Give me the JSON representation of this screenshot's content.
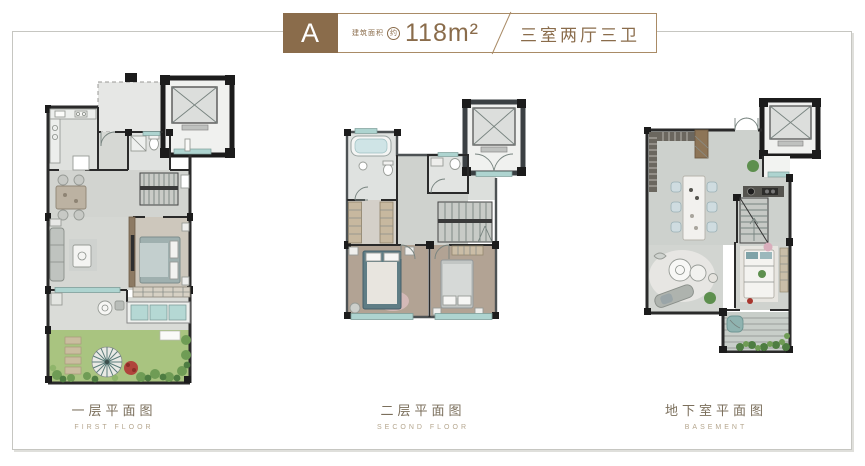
{
  "header": {
    "unit_label": "A",
    "area_prefix": "建筑面积",
    "area_approx": "约",
    "area_value": "118m²",
    "separator": "/",
    "layout_label": "三室两厅三卫"
  },
  "plans": [
    {
      "title": "一层平面图",
      "subtitle": "FIRST FLOOR"
    },
    {
      "title": "二层平面图",
      "subtitle": "SECOND FLOOR"
    },
    {
      "title": "地下室平面图",
      "subtitle": "BASEMENT"
    }
  ],
  "colors": {
    "accent_brown": "#8A6C4B",
    "wall_dark": "#2A2A2A",
    "floor_gray": "#D3D5D1",
    "window_teal": "#AED4D0",
    "garden_green": "#A9C480",
    "wood_floor": "#B2A394"
  }
}
